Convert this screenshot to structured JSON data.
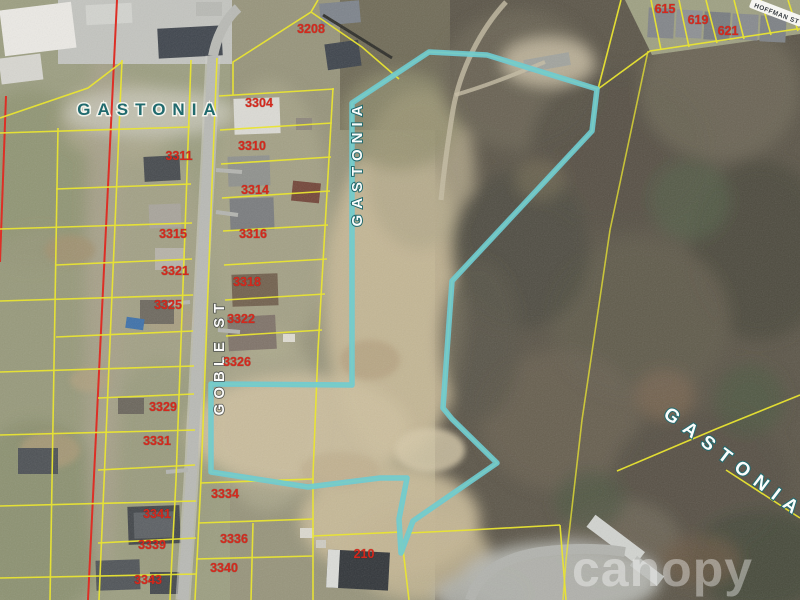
{
  "map": {
    "watermark": "canopy",
    "colors": {
      "highlight": "#6fcbd1",
      "parcel_line": "#e9e432",
      "railroad": "#dd2f26",
      "parcel_number": "#d5281c",
      "city_dark": "#206a6e",
      "label_light": "#fbfdfc"
    },
    "highlight_parcel": {
      "points": "352,103 429,52 487,55 597,89 592,131 452,281 443,408 452,419 497,463 413,521 401,553 399,519 407,478 380,478 308,487 211,472 211,384 352,385"
    },
    "city_labels": [
      {
        "text": "GASTONIA",
        "x": 150,
        "y": 115,
        "rotation": 0,
        "variant": "dark",
        "size": 17,
        "spacing": 7
      },
      {
        "text": "GASTONIA",
        "x": 362,
        "y": 163,
        "rotation": -90,
        "variant": "light",
        "size": 15,
        "spacing": 6
      },
      {
        "text": "GASTONIA",
        "x": 731,
        "y": 468,
        "rotation": 37,
        "variant": "light",
        "size": 19,
        "spacing": 9
      }
    ],
    "street_labels": [
      {
        "text": "GOBLE ST",
        "x": 224,
        "y": 352,
        "rotation": -90,
        "pill": false,
        "size": 15,
        "spacing": 5
      },
      {
        "text": "HOFFMAN ST",
        "x": 776,
        "y": 13,
        "rotation": 21,
        "pill": true,
        "size": 6.5,
        "spacing": 0.5
      }
    ],
    "parcel_numbers": [
      {
        "text": "3208",
        "x": 311,
        "y": 33
      },
      {
        "text": "3304",
        "x": 259,
        "y": 107
      },
      {
        "text": "3310",
        "x": 252,
        "y": 150
      },
      {
        "text": "3311",
        "x": 179,
        "y": 160
      },
      {
        "text": "3314",
        "x": 255,
        "y": 194
      },
      {
        "text": "3315",
        "x": 173,
        "y": 238
      },
      {
        "text": "3316",
        "x": 253,
        "y": 238
      },
      {
        "text": "3321",
        "x": 175,
        "y": 275
      },
      {
        "text": "3318",
        "x": 247,
        "y": 286
      },
      {
        "text": "3325",
        "x": 168,
        "y": 309
      },
      {
        "text": "3322",
        "x": 241,
        "y": 323
      },
      {
        "text": "3326",
        "x": 237,
        "y": 366
      },
      {
        "text": "3329",
        "x": 163,
        "y": 411
      },
      {
        "text": "3331",
        "x": 157,
        "y": 445
      },
      {
        "text": "3334",
        "x": 225,
        "y": 498
      },
      {
        "text": "3341",
        "x": 157,
        "y": 518
      },
      {
        "text": "3336",
        "x": 234,
        "y": 543
      },
      {
        "text": "3339",
        "x": 152,
        "y": 549
      },
      {
        "text": "3340",
        "x": 224,
        "y": 572
      },
      {
        "text": "3343",
        "x": 148,
        "y": 584
      },
      {
        "text": "210",
        "x": 364,
        "y": 558
      },
      {
        "text": "615",
        "x": 665,
        "y": 13
      },
      {
        "text": "619",
        "x": 698,
        "y": 24
      },
      {
        "text": "621",
        "x": 728,
        "y": 35
      }
    ]
  }
}
